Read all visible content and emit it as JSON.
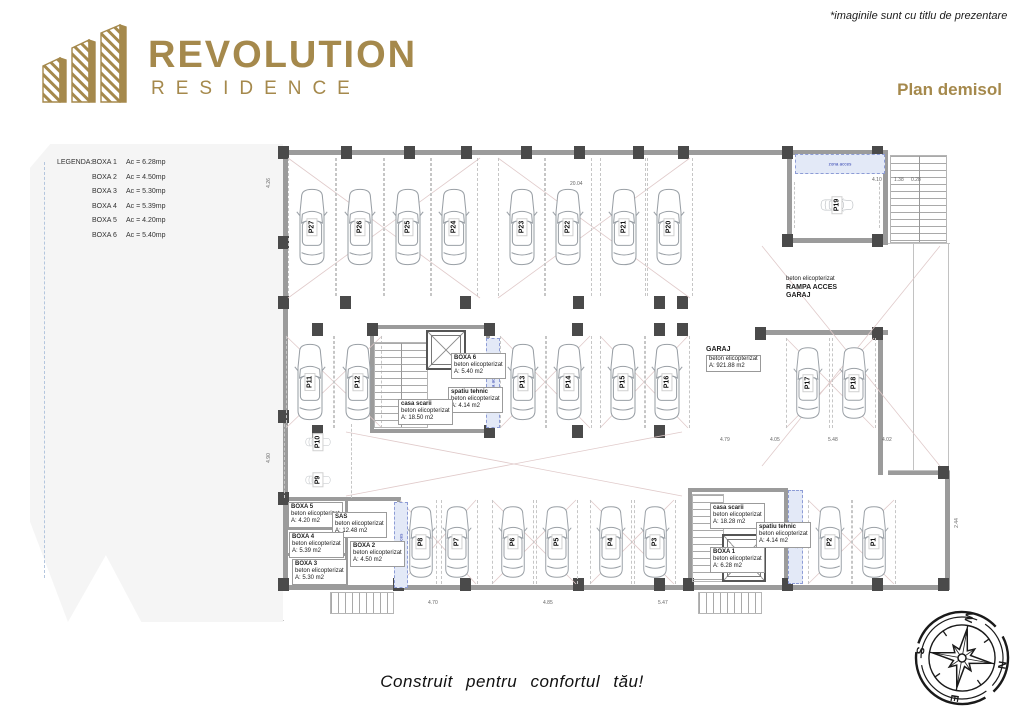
{
  "header": {
    "logo_title": "REVOLUTION",
    "logo_subtitle": "RESIDENCE",
    "note": "*imaginile sunt cu titlu de prezentare",
    "plan_title": "Plan demisol"
  },
  "colors": {
    "gold": "#A5894C",
    "wall_gray": "#9b9b9b",
    "column_dark": "#4a4a4a",
    "blue_zone_fill": "#e3e9f7",
    "blue_zone_text": "#2f3fae",
    "site_gray": "#f5f5f5"
  },
  "legend": {
    "title": "LEGENDA:",
    "items": [
      {
        "label": "BOXA 1",
        "value": "Ac = 6.28mp"
      },
      {
        "label": "BOXA 2",
        "value": "Ac = 4.50mp"
      },
      {
        "label": "BOXA 3",
        "value": "Ac = 5.30mp"
      },
      {
        "label": "BOXA 4",
        "value": "Ac = 5.39mp"
      },
      {
        "label": "BOXA 5",
        "value": "Ac = 4.20mp"
      },
      {
        "label": "BOXA 6",
        "value": "Ac = 5.40mp"
      }
    ]
  },
  "plan": {
    "garaj": {
      "name": "GARAJ",
      "material": "beton elicopterizat",
      "area": "A: 921.88 m2"
    },
    "ramp": {
      "line1": "beton elicopterizat",
      "line2": "RAMPA ACCES",
      "line3": "GARAJ"
    },
    "blue_zone_label": "zona acces",
    "rooms": [
      {
        "name": "BOXA 5",
        "material": "beton elicopterizat",
        "area": "A: 4.20 m2"
      },
      {
        "name": "SAS",
        "material": "beton elicopterizat",
        "area": "A: 12.48 m2"
      },
      {
        "name": "BOXA 4",
        "material": "beton elicopterizat",
        "area": "A: 5.39 m2"
      },
      {
        "name": "BOXA 3",
        "material": "beton elicopterizat",
        "area": "A: 5.30 m2"
      },
      {
        "name": "BOXA 2",
        "material": "beton elicopterizat",
        "area": "A: 4.50 m2"
      },
      {
        "name": "BOXA 6",
        "material": "beton elicopterizat",
        "area": "A: 5.40 m2"
      },
      {
        "name": "spatiu tehnic",
        "material": "beton elicopterizat",
        "area": "A: 4.14 m2"
      },
      {
        "name": "casa scarii",
        "material": "beton elicopterizat",
        "area": "A: 18.50 m2"
      },
      {
        "name": "casa scarii",
        "material": "beton elicopterizat",
        "area": "A: 18.28 m2"
      },
      {
        "name": "spatiu tehnic",
        "material": "beton elicopterizat",
        "area": "A: 4.14 m2"
      },
      {
        "name": "BOXA 1",
        "material": "beton elicopterizat",
        "area": "A: 6.28 m2"
      }
    ],
    "parking": {
      "top_row": [
        "P27",
        "P26",
        "P25",
        "P24",
        "P23",
        "P22",
        "P21",
        "P20"
      ],
      "mid_left": [
        "P11",
        "P12"
      ],
      "mid_center": [
        "P13",
        "P14",
        "P15",
        "P16"
      ],
      "mid_right": [
        "P17",
        "P18"
      ],
      "left_col": [
        "P10",
        "P9"
      ],
      "bottom_row": [
        "P8",
        "P7",
        "P6",
        "P5",
        "P4",
        "P3"
      ],
      "bottom_right": [
        "P2",
        "P1"
      ],
      "single": [
        "P19"
      ]
    },
    "dims": [
      "4.26",
      "4.10",
      "1.38",
      "0.28",
      "20.04",
      "4.79",
      "4.05",
      "5.48",
      "4.02",
      "4.70",
      "4.85",
      "5.47",
      "2.44",
      "4.90"
    ]
  },
  "footer": {
    "tagline": "Construit  pentru  confortul  tău!"
  },
  "compass": {
    "n": "N",
    "e": "E",
    "s": "S",
    "w": "W"
  }
}
